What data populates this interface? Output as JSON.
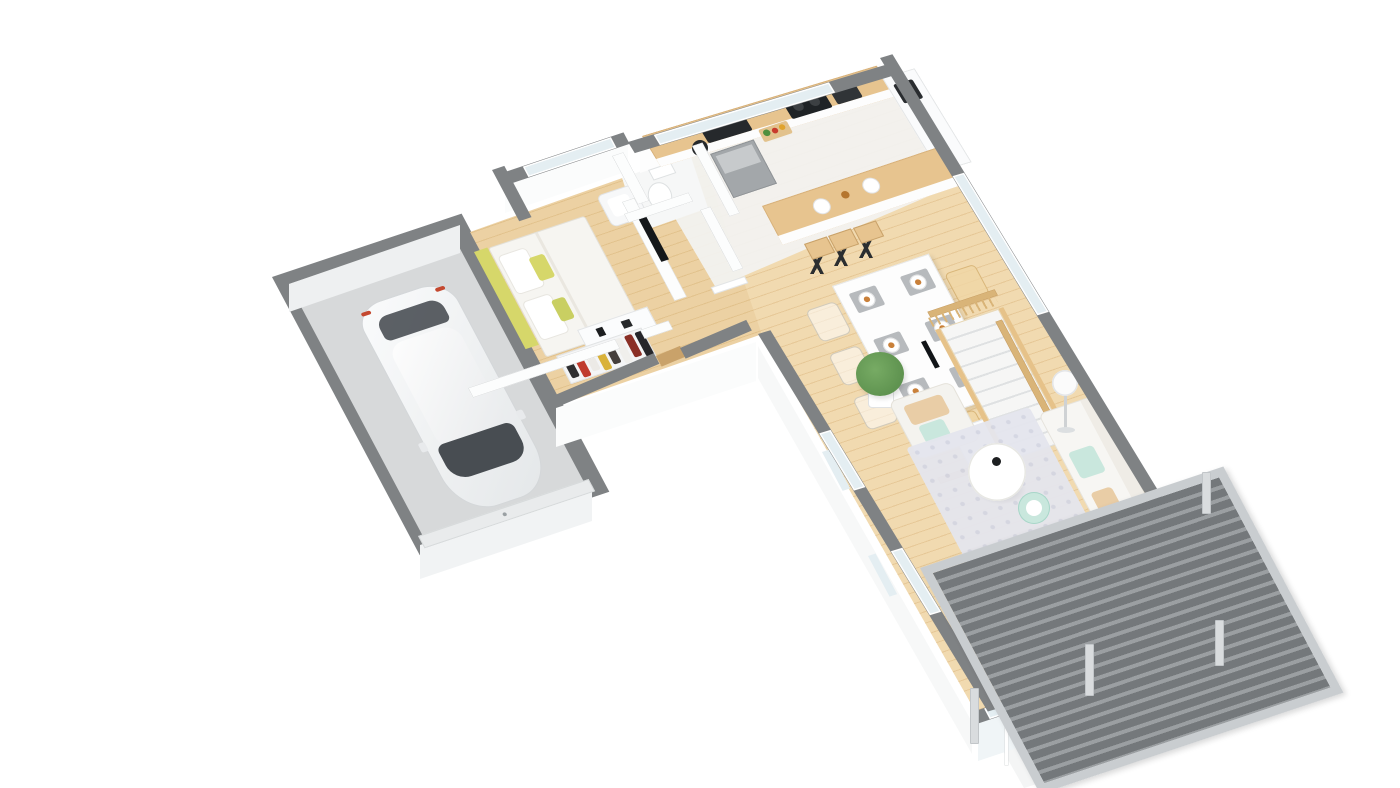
{
  "meta": {
    "type": "3d-floorplan-render",
    "projection": "isometric-perspective",
    "background": "#ffffff",
    "visible_text": ""
  },
  "palette": {
    "wall": "#7f8284",
    "innerWall": "#fcfdfd",
    "wallFace": "#fbfcfc",
    "woodA": "#ecd1a3",
    "woodB": "#e2c28d",
    "woodLight": "#f1dab0",
    "woodC": "#e6c897",
    "garageFloor": "#d7d9da",
    "garageFace": "#eef0f1",
    "kitchenFloor": "#f2f2f0",
    "counterWood": "#e7c48f",
    "glass": "#e4eef2",
    "carBody": "#f0f2f3",
    "carGlass": "#3a3f44",
    "black": "#2b2e30",
    "fridge": "#a3a7aa",
    "accentYellow": "#d6d76a",
    "accentYellow2": "#c9cf62",
    "accentMint": "#c9e7dd",
    "accentBeige": "#e9cda6",
    "mat": "#b7babd",
    "rug": "#e5e6ee",
    "rugDot": "#d4d6e3",
    "sofa": "#f7f6f3",
    "stairWood": "#e6c289",
    "railWood": "#d9b478",
    "pergSlat": "#74787b",
    "pergGap": "#9b9fa2",
    "pergFrame": "#c9cdd0",
    "post": "#d9dcde",
    "slab": "#f4f5f5",
    "threshold": "#c9a26a",
    "plantGreen": "#5f9350",
    "plantGreen2": "#77ab64",
    "clothes": [
      "#2e2e30",
      "#c03b2e",
      "#eceae6",
      "#d9b23a",
      "#453f3c",
      "#f0efec",
      "#8a2f26",
      "#26262a"
    ]
  },
  "inventory": {
    "rooms": [
      "garage",
      "bedroom",
      "wc",
      "entrance-hall",
      "kitchen",
      "dining-area",
      "living-room",
      "terrace-pergola"
    ],
    "car": 1,
    "bed": 1,
    "toilet": 1,
    "clothes_items": 8,
    "bar_stools": 3,
    "dining_place_settings": 6,
    "dining_chairs": 6,
    "armchair": 1,
    "sofa": 1,
    "coffee_table": 1,
    "side_table": 1,
    "floor_lamp": 1,
    "plant": 1,
    "staircase": 1,
    "pergola_posts": 4,
    "glass_door_panels": 3
  }
}
